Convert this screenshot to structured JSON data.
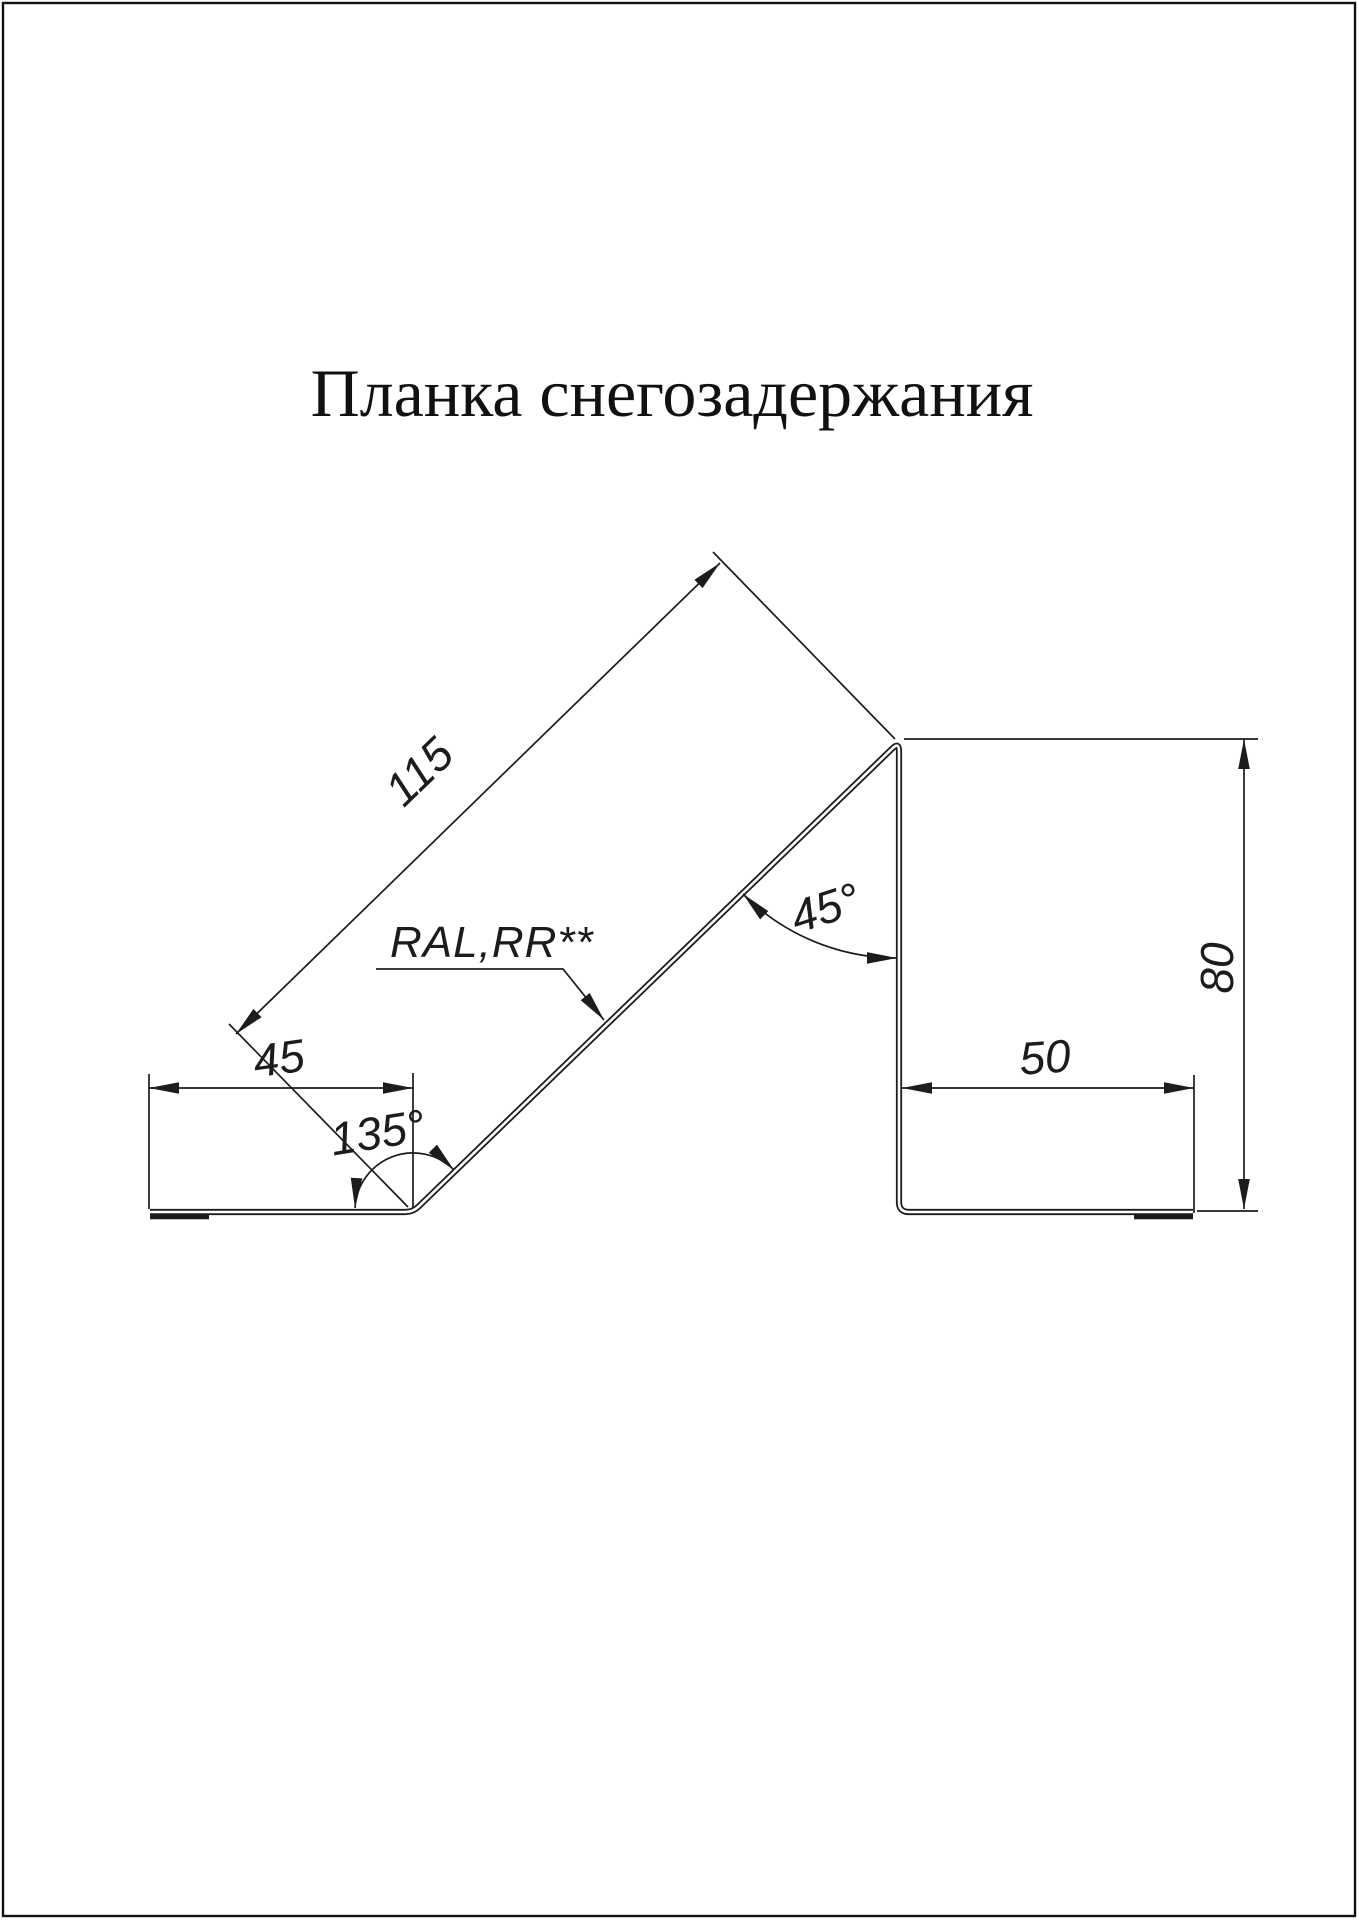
{
  "page": {
    "title": "Планка снегозадержания",
    "background": "#ffffff",
    "line_color": "#1c1c1c"
  },
  "drawing": {
    "coating_label": "RAL,RR**",
    "dimensions": {
      "slope_length": "115",
      "left_flange_width": "45",
      "bend_angle": "135°",
      "top_angle": "45°",
      "right_flange_width": "50",
      "vertical_height": "80"
    }
  }
}
